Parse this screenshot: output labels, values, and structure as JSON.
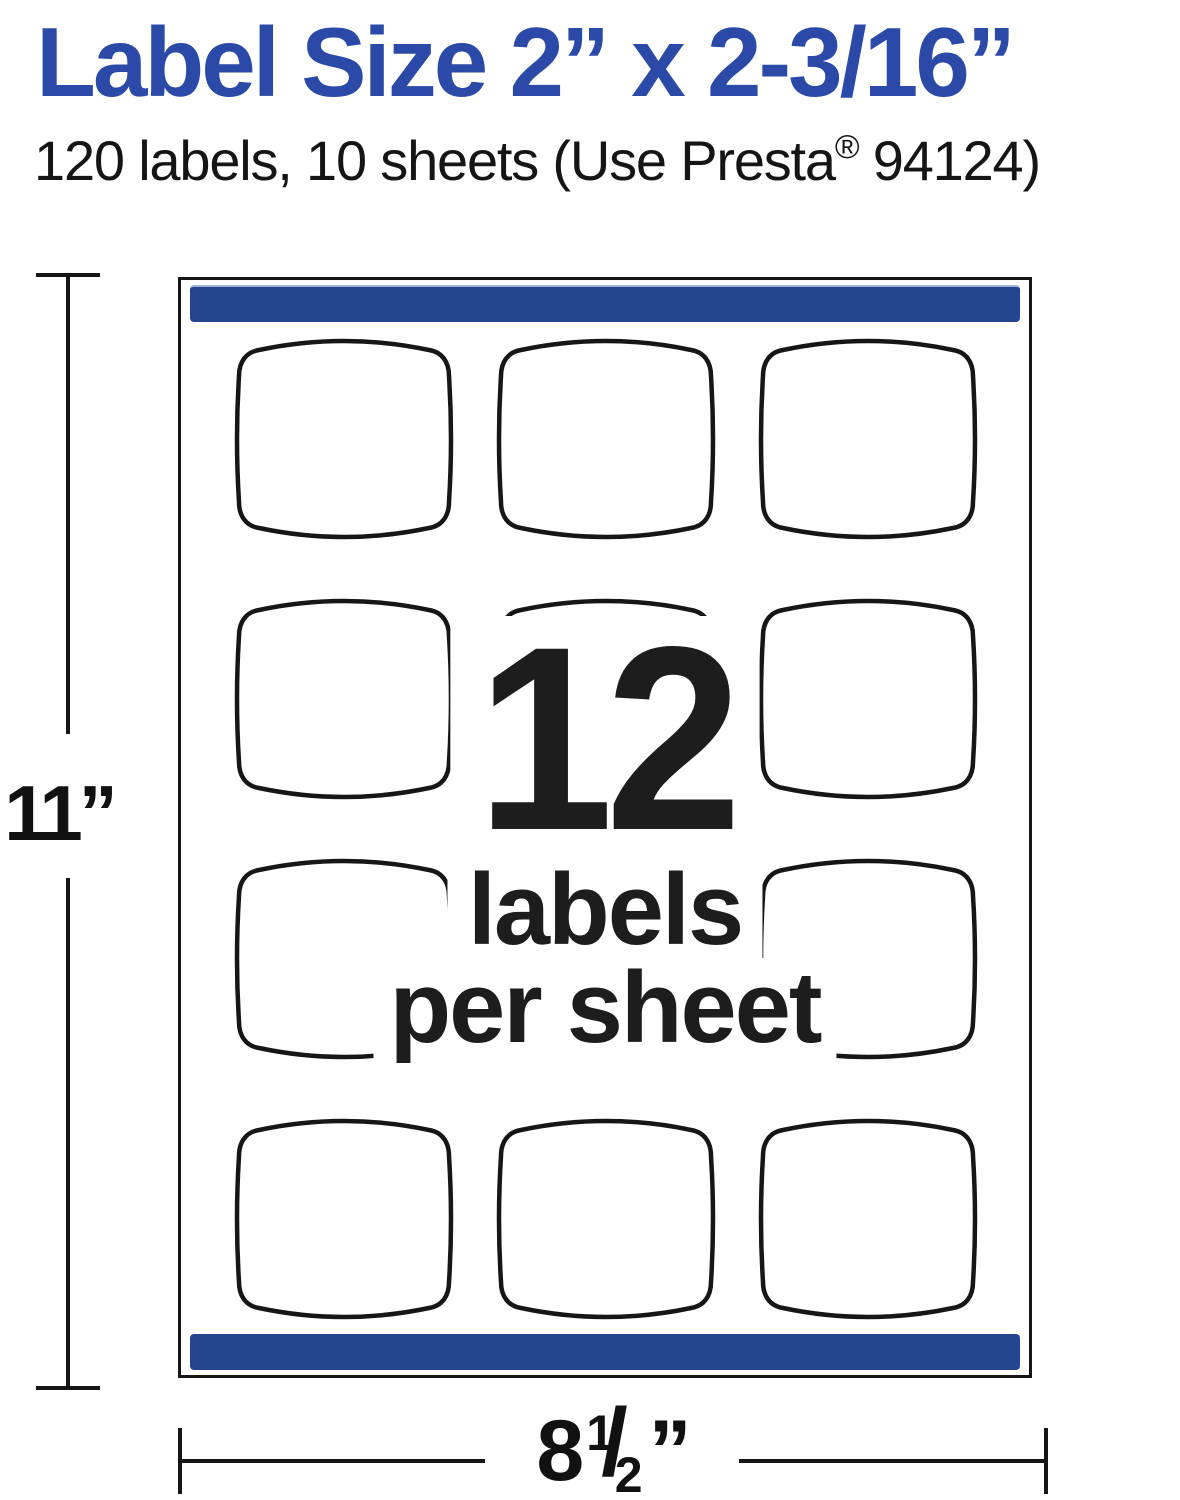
{
  "header": {
    "title": "Label Size 2” x 2-3/16”",
    "subtitle_pre": "120 labels, 10 sheets (Use Presta",
    "subtitle_reg_mark": "®",
    "subtitle_post": " 94124)"
  },
  "sheet": {
    "grid": {
      "rows": 4,
      "cols": 3
    },
    "center_overlay": {
      "count": "12",
      "line1": "labels",
      "line2": "per sheet"
    }
  },
  "dimensions": {
    "height_label": "11”",
    "width_whole": "8",
    "width_frac_numerator": "1",
    "width_frac_slash": "/",
    "width_frac_denominator": "2",
    "width_unit": "”"
  },
  "colors": {
    "title_blue": "#2b49a6",
    "bar_blue": "#24468f",
    "ink": "#161616"
  }
}
